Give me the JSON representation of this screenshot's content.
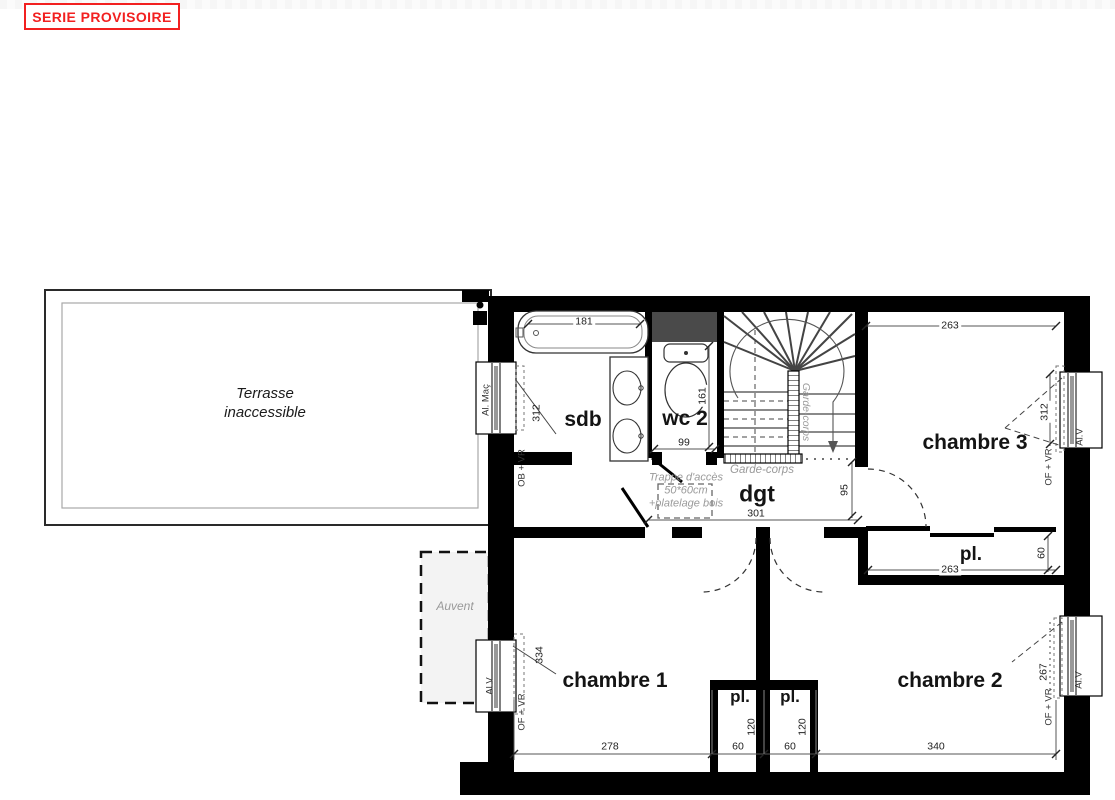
{
  "stamp": {
    "label": "SERIE PROVISOIRE",
    "color": "#f22020"
  },
  "rooms": {
    "terrasse_line1": "Terrasse",
    "terrasse_line2": "inaccessible",
    "sdb": "sdb",
    "wc2": "wc 2",
    "dgt": "dgt",
    "chambre1": "chambre 1",
    "chambre2": "chambre 2",
    "chambre3": "chambre 3",
    "pl_right": "pl.",
    "pl_bottom_left": "pl.",
    "pl_bottom_right": "pl.",
    "auvent": "Auvent"
  },
  "annotations": {
    "garde_corps_bottom": "Garde-corps",
    "garde_corps_vertical": "Garde-corps",
    "trappe_line1": "Trappe d'accès",
    "trappe_line2": "50*60cm",
    "trappe_line3": "+platelage bois"
  },
  "windows": {
    "sdb_outside": "Al. Maç",
    "sdb_inside": "OB + VR",
    "ch3_outside": "Al.V",
    "ch3_inside": "OF + VR",
    "ch1_outside": "Al.V",
    "ch1_inside": "OF + VR",
    "ch2_outside": "Al.V",
    "ch2_inside": "OF + VR"
  },
  "dimensions": {
    "tub_width": "181",
    "wc_depth": "161",
    "wc_width": "99",
    "ch3_top": "263",
    "win_ch3": "312",
    "win_sdb": "312",
    "dgt_width": "301",
    "dgt_depth": "95",
    "pl_width": "263",
    "pl_depth": "60",
    "win_ch1": "334",
    "win_ch2": "267",
    "ch1_width": "278",
    "pl_b_left_w": "60",
    "pl_b_right_w": "60",
    "ch2_width": "340",
    "pl_b_left_d": "120",
    "pl_b_right_d": "120"
  },
  "colors": {
    "wall": "#000000",
    "duct": "#4a4a4a",
    "annotation": "#9a9a9a"
  }
}
